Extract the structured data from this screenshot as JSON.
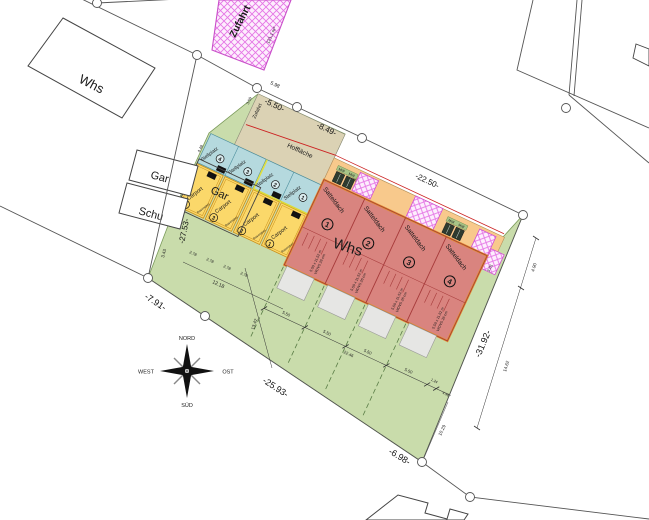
{
  "labels": {
    "whs_neighbor": "Whs",
    "gar": "Gar",
    "schu": "Schu",
    "gar_outline": "Gar",
    "zufahrt": "Zufahrt",
    "zufahrt_area": "121,1 m²",
    "zufahrt_lane": "Zufahrt",
    "hofflaeche": "Hoffläche",
    "weg": "Weg",
    "muell": "Müll",
    "stellplatz": "Stellplatz",
    "carport": "Carport",
    "sw_marker": "SW",
    "carport_surface": "Rasenstein",
    "satteldach": "Satteldach",
    "whs_houses": "Whs",
    "house_size": "5,50 x 11,52 m",
    "house_insulation": "WDVS 26 cm"
  },
  "numbers": [
    "1",
    "2",
    "3",
    "4"
  ],
  "compass": {
    "north": "NORD",
    "east": "OST",
    "south": "SÜD",
    "west": "WEST"
  },
  "dimensions": {
    "d1": "-5.50-",
    "d2": "-8.49-",
    "d3": "-22.50-",
    "d4": "-27.53-",
    "d5": "-7.91-",
    "d6": "-25.93-",
    "d7": "-31.92-",
    "d8": "-6.98-"
  },
  "small_dimensions": {
    "s598": "5.98",
    "s359": "3.59",
    "s343": "3.43",
    "s278": "2.78",
    "s1218": "12.18",
    "s1342": "13.42",
    "s448": "4.48",
    "s301": "3.01",
    "s490": "4.90",
    "s1462": "14.62",
    "s550": "5.50",
    "s124": "1.24",
    "s498": "4.98",
    "s2246": "22.46",
    "s1029": "10.29"
  },
  "colors": {
    "parcel_green": "#c9dcab",
    "hof_beige": "#dbd2b4",
    "stellplatz_blue": "#b5d9de",
    "carport_yellow": "#fbd86a",
    "house_red": "#d9847f",
    "house_outline_orange": "#e2902f",
    "weg_peach": "#f8c98c",
    "zufahrt_pink": "#e06ee0",
    "dashed_green": "#5a7d46",
    "red_line": "#cc2222"
  }
}
